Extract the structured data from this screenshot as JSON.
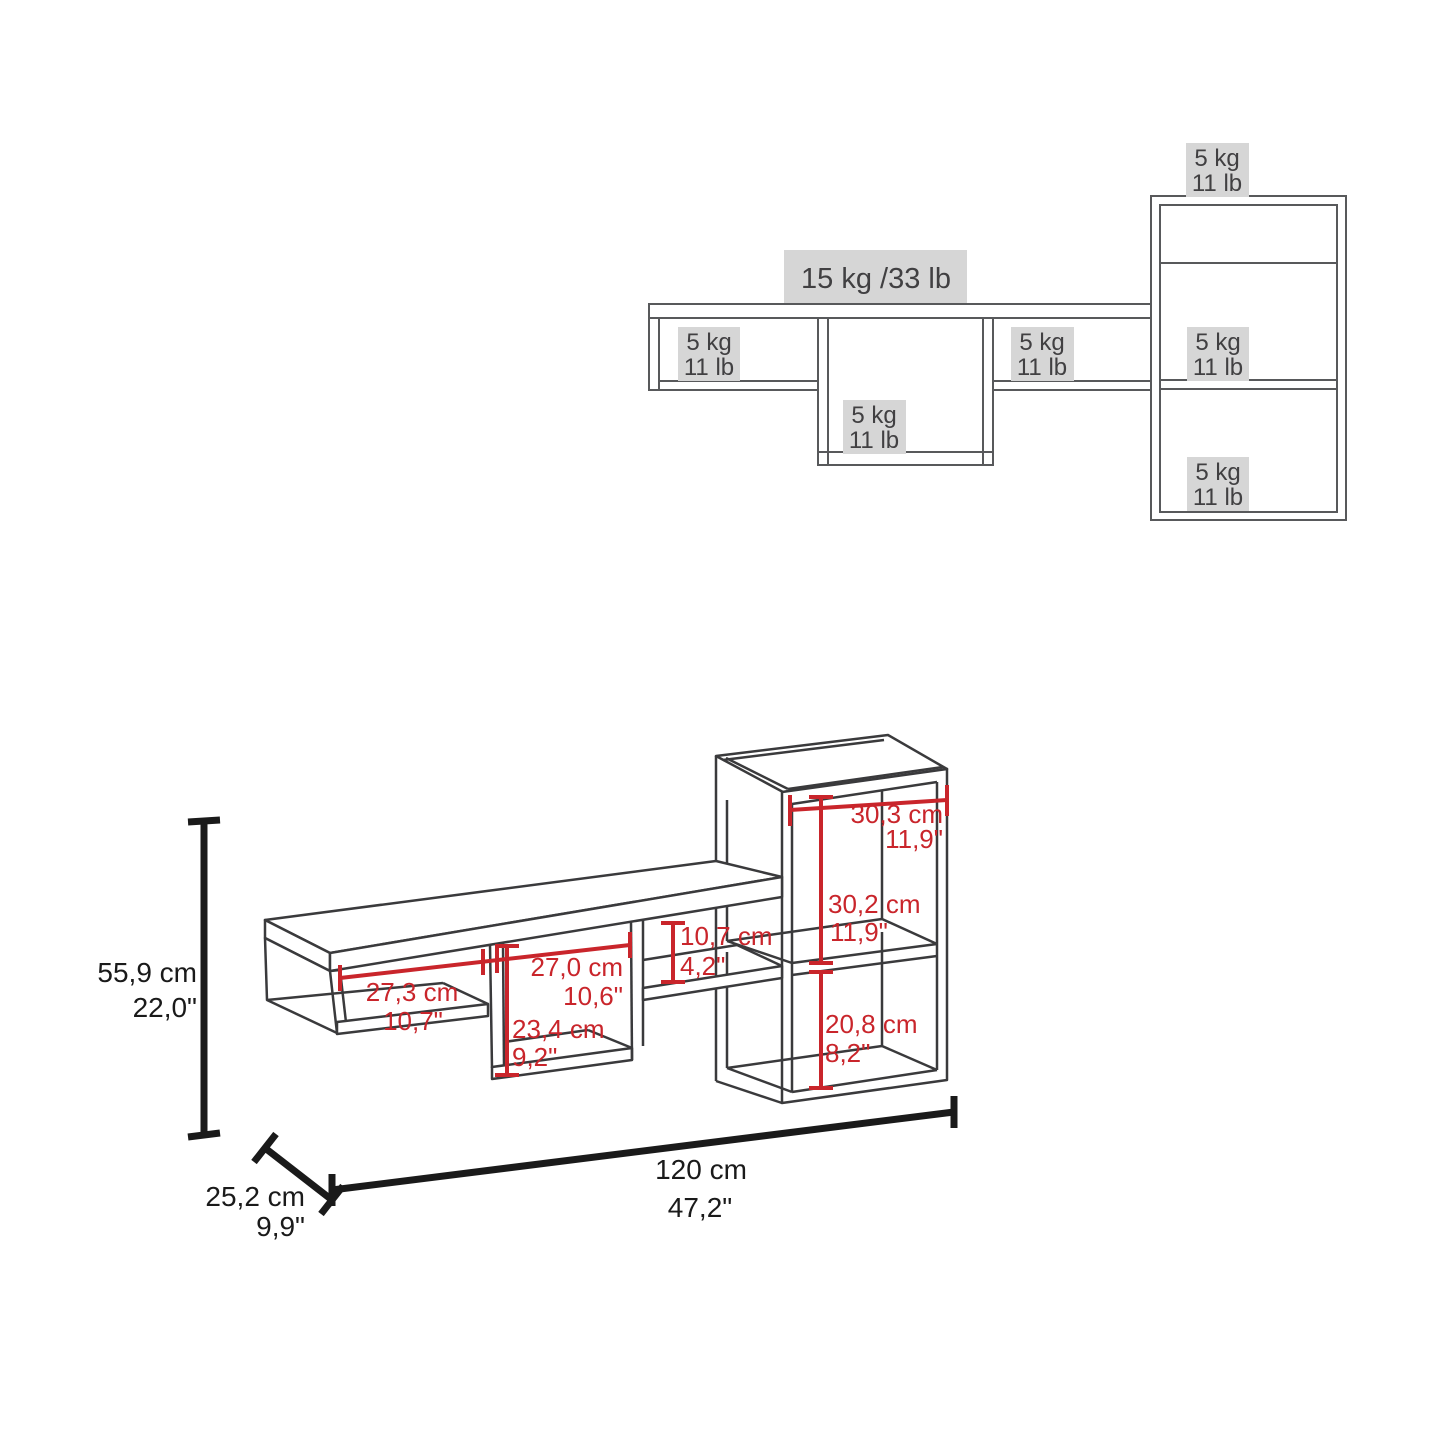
{
  "colors": {
    "dimension_red": "#c9252b",
    "capacity_line_gray": "#58595b",
    "label_box_gray": "#d6d6d6",
    "label_text_gray": "#414042",
    "outline_dark": "#3a3a3c",
    "extent_black": "#1a1a1a"
  },
  "capacity_diagram": {
    "main_shelf_capacity": "15 kg /33 lb",
    "tower_top_capacity": {
      "line1": "5 kg",
      "line2": "11 lb"
    },
    "left_cubby_capacity": {
      "line1": "5 kg",
      "line2": "11 lb"
    },
    "center_cubby_capacity": {
      "line1": "5 kg",
      "line2": "11 lb"
    },
    "right_cubby_capacity": {
      "line1": "5 kg",
      "line2": "11 lb"
    },
    "tower_middle_capacity": {
      "line1": "5 kg",
      "line2": "11 lb"
    },
    "tower_bottom_capacity": {
      "line1": "5 kg",
      "line2": "11 lb"
    }
  },
  "dimensions_diagram": {
    "left_cubby_width": {
      "cm": "27,3 cm",
      "inch": "10,7\""
    },
    "center_cubby_width": {
      "cm": "27,0 cm",
      "inch": "10,6\""
    },
    "center_cubby_height": {
      "cm": "23,4 cm",
      "inch": "9,2\""
    },
    "right_opening_height": {
      "cm": "10,7 cm",
      "inch": "4,2\""
    },
    "tower_inner_width": {
      "cm": "30,3 cm",
      "inch": "11,9\""
    },
    "tower_upper_cubby_height": {
      "cm": "30,2 cm",
      "inch": "11,9\""
    },
    "tower_lower_cubby_height": {
      "cm": "20,8 cm",
      "inch": "8,2\""
    },
    "overall_height": {
      "cm": "55,9 cm",
      "inch": "22,0\""
    },
    "overall_depth": {
      "cm": "25,2 cm",
      "inch": "9,9\""
    },
    "overall_width": {
      "cm": "120 cm",
      "inch": "47,2\""
    }
  }
}
